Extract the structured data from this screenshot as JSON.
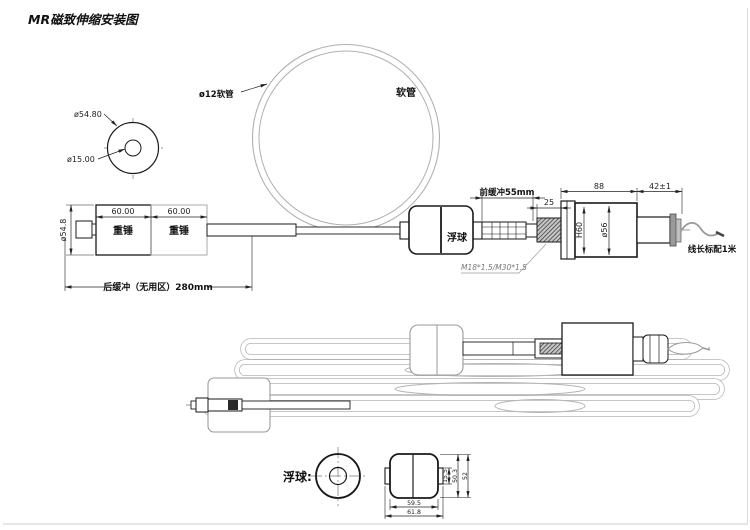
{
  "title": "MR磁致伸缩安装图",
  "colors": {
    "line": "#1a1a1a",
    "dimension": "#222222",
    "phantom_gray": "#b0b0b0",
    "leader_gray": "#8a8a8a",
    "paper": "#ffffff"
  },
  "weight_front_view": {
    "outer_dia": "ø54.80",
    "inner_dia": "ø15.00"
  },
  "hose": {
    "dia_label": "ø12软管",
    "name_label": "软管"
  },
  "main_view": {
    "weight1": "重锤",
    "weight2": "重锤",
    "weight1_width": "60.00",
    "weight2_width": "60.00",
    "weight_dia": "ø54.8",
    "rear_buffer": "后缓冲（无用区）280mm",
    "float_label": "浮球",
    "front_buffer": "前缓冲55mm",
    "gland_len": "25",
    "body_len": "88",
    "tail_len": "42±1",
    "body_height": "H60",
    "body_dia": "ø56",
    "thread_spec": "M18*1.5/M30*1.5",
    "cable_note": "线长标配1米"
  },
  "float_detail": {
    "caption": "浮球:",
    "height_overall": "52",
    "height_body": "50.3",
    "hole_dia": "15.5",
    "width_body": "59.5",
    "width_overall": "61.8"
  }
}
